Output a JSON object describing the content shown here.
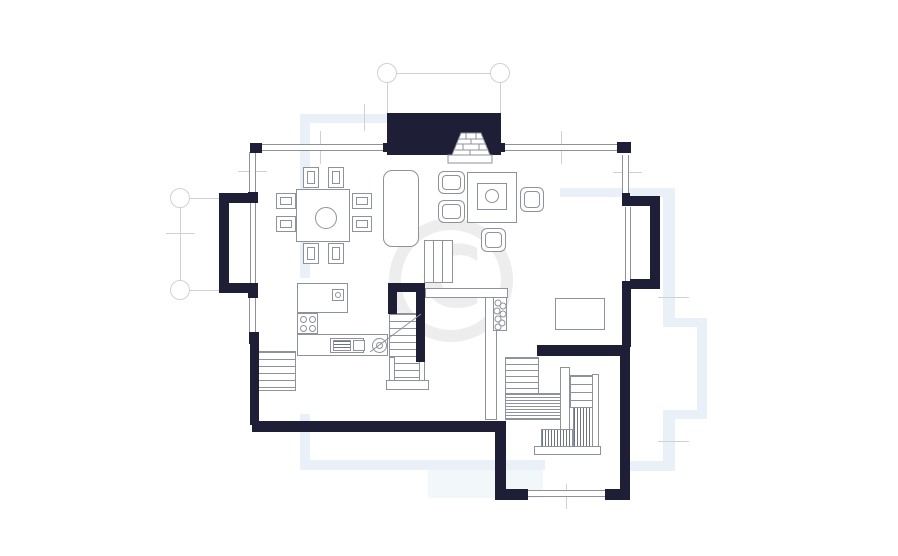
{
  "colors": {
    "background": "#ffffff",
    "wall": "#1e1e37",
    "line": "#8d929b",
    "line2": "#6e7380",
    "grid": "#cfd1d8",
    "ghost": "#e9f0f7",
    "ghost-fill": "#f2f7fa",
    "watermark": "#ededed"
  },
  "watermark": {
    "glyph": "C"
  },
  "plan": {
    "type": "residential-floor-plan",
    "inventory": {
      "grid_marker_bubbles": 4,
      "bay_windows": 2,
      "fireplace_with_chimney": 1,
      "dining_table": 1,
      "dining_chairs": 8,
      "sofa": 1,
      "sideboard": 1,
      "armchairs": 4,
      "coffee_table": 1,
      "cabinet": 1,
      "kitchen_counters": 2,
      "cooktop_burners": 4,
      "sinks": 2,
      "oven": 1,
      "staircases": 3,
      "windows": 7,
      "glass_divider": 1
    }
  }
}
